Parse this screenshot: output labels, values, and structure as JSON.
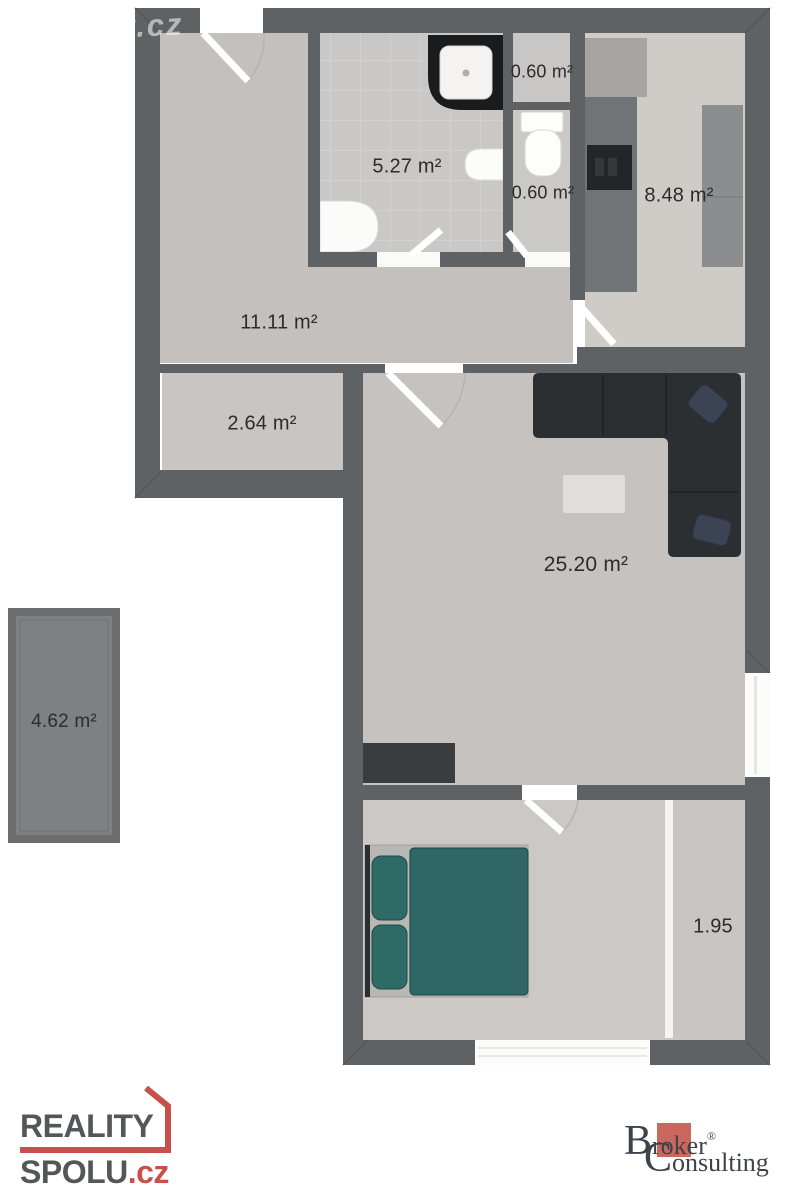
{
  "watermark": {
    "text": "y.cz"
  },
  "plan": {
    "rooms": {
      "hallway": {
        "label": "11.11 m²"
      },
      "bathroom": {
        "label": "5.27 m²"
      },
      "closet_top": {
        "label": "0.60 m²"
      },
      "wc": {
        "label": "0.60 m²"
      },
      "kitchen": {
        "label": "8.48 m²"
      },
      "storage": {
        "label": "2.64 m²"
      },
      "living_room": {
        "label": "25.20 m²"
      },
      "balcony": {
        "label": "4.62 m²"
      },
      "wardrobe": {
        "label": "1.95"
      }
    },
    "fixture_icons": [
      "shower-icon",
      "toilet-icon",
      "sink-icon",
      "washbasin-icon",
      "kitchen-counter-icon",
      "stove-icon",
      "sofa-icon",
      "coffee-table-icon",
      "tv-stand-icon",
      "double-bed-icon",
      "window-icon",
      "door-icon"
    ]
  },
  "footer": {
    "reality_spolu": {
      "word1": "REALITY",
      "word2": "SPOLU",
      "tld": ".cz"
    },
    "broker_consulting": {
      "b_initial": "B",
      "b_rest": "roker",
      "reg": "®",
      "c_initial": "C",
      "c_rest": "onsulting"
    }
  },
  "colors": {
    "wall": "#5f6264",
    "floor_light": "#c6c3c0",
    "tile": "#cac8c6",
    "sofa": "#2c2f32",
    "bed_teal": "#2e6765",
    "logo_red": "#c8504b",
    "broker_red": "#ca675e"
  }
}
